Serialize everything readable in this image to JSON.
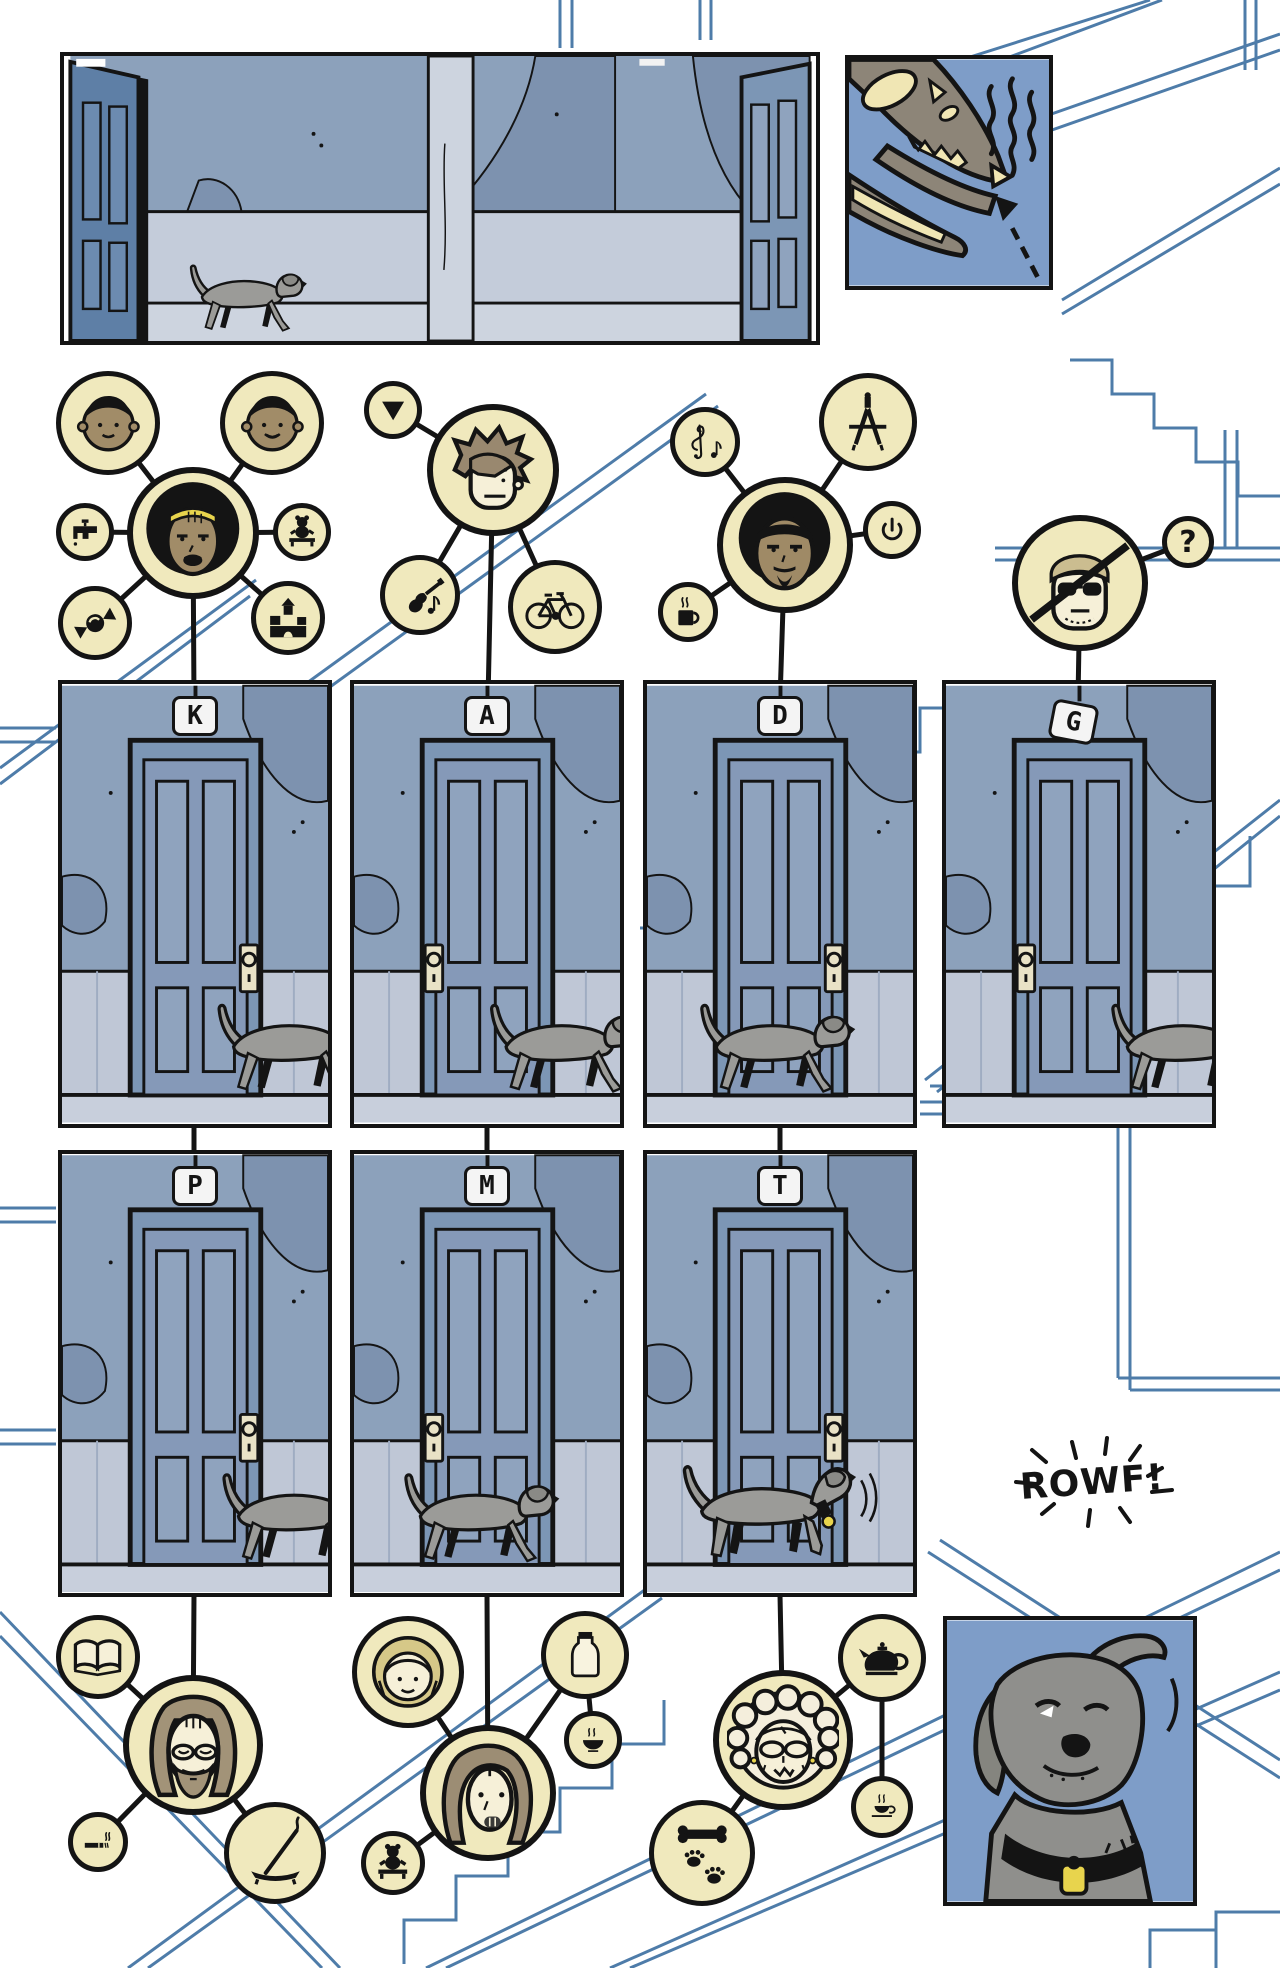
{
  "palette": {
    "ink": "#141414",
    "staircase_blue": "#4E7CA9",
    "icon_cream": "#F0E9BD",
    "wall_blue_gray": "#8CA1BB",
    "wall_patch": "#7D92AF",
    "wainscot": "#BFC7D6",
    "door_blue": "#7C96B5",
    "panel_sky_blue": "#7E9DC8",
    "dog_gray": "#9B9B98",
    "accent_yellow": "#E8D44D",
    "bone_cream": "#F0E6B4"
  },
  "doors": [
    {
      "letter": "K"
    },
    {
      "letter": "A"
    },
    {
      "letter": "D"
    },
    {
      "letter": "G"
    },
    {
      "letter": "P"
    },
    {
      "letter": "M"
    },
    {
      "letter": "T"
    }
  ],
  "sfx": {
    "bark": "ROWF!"
  },
  "badges": {
    "question": "?"
  },
  "panels": {
    "hallway": {
      "description": "gray dog walking right along an apartment hallway"
    },
    "dinosaur": {
      "description": "dinosaur skull with smell lines and dashed arrow"
    },
    "dog_closeup": {
      "description": "gray dog close-up with collar tag"
    }
  },
  "clusters": {
    "k": {
      "door": "K",
      "center": "woman with yellow headband",
      "linked_icons": [
        "child-face",
        "child-face",
        "faucet",
        "teddy-bear",
        "candy",
        "toy-blocks"
      ]
    },
    "a": {
      "door": "A",
      "center": "person with spiky hair",
      "linked_icons": [
        "triangle-down",
        "guitar-and-note",
        "bicycle"
      ]
    },
    "d": {
      "door": "D",
      "center": "man with afro and goatee",
      "linked_icons": [
        "treble-clef-and-note",
        "drafting-compass",
        "power-button",
        "coffee-mug"
      ]
    },
    "g": {
      "door": "G",
      "center": "man in cap and sunglasses, crossed out",
      "linked_icons": [
        "question-mark"
      ]
    },
    "p": {
      "door": "P",
      "center": "long-haired bearded man",
      "linked_icons": [
        "open-book",
        "cigarette",
        "incense-burner"
      ]
    },
    "m": {
      "door": "M",
      "center": "woman with long brown hair",
      "linked_icons": [
        "girl-face",
        "milk-bottle",
        "food-bowl",
        "teddy-bear"
      ]
    },
    "t": {
      "door": "T",
      "center": "grandmother with glasses",
      "linked_icons": [
        "teapot",
        "teacup",
        "bone-and-paw-prints"
      ]
    }
  }
}
